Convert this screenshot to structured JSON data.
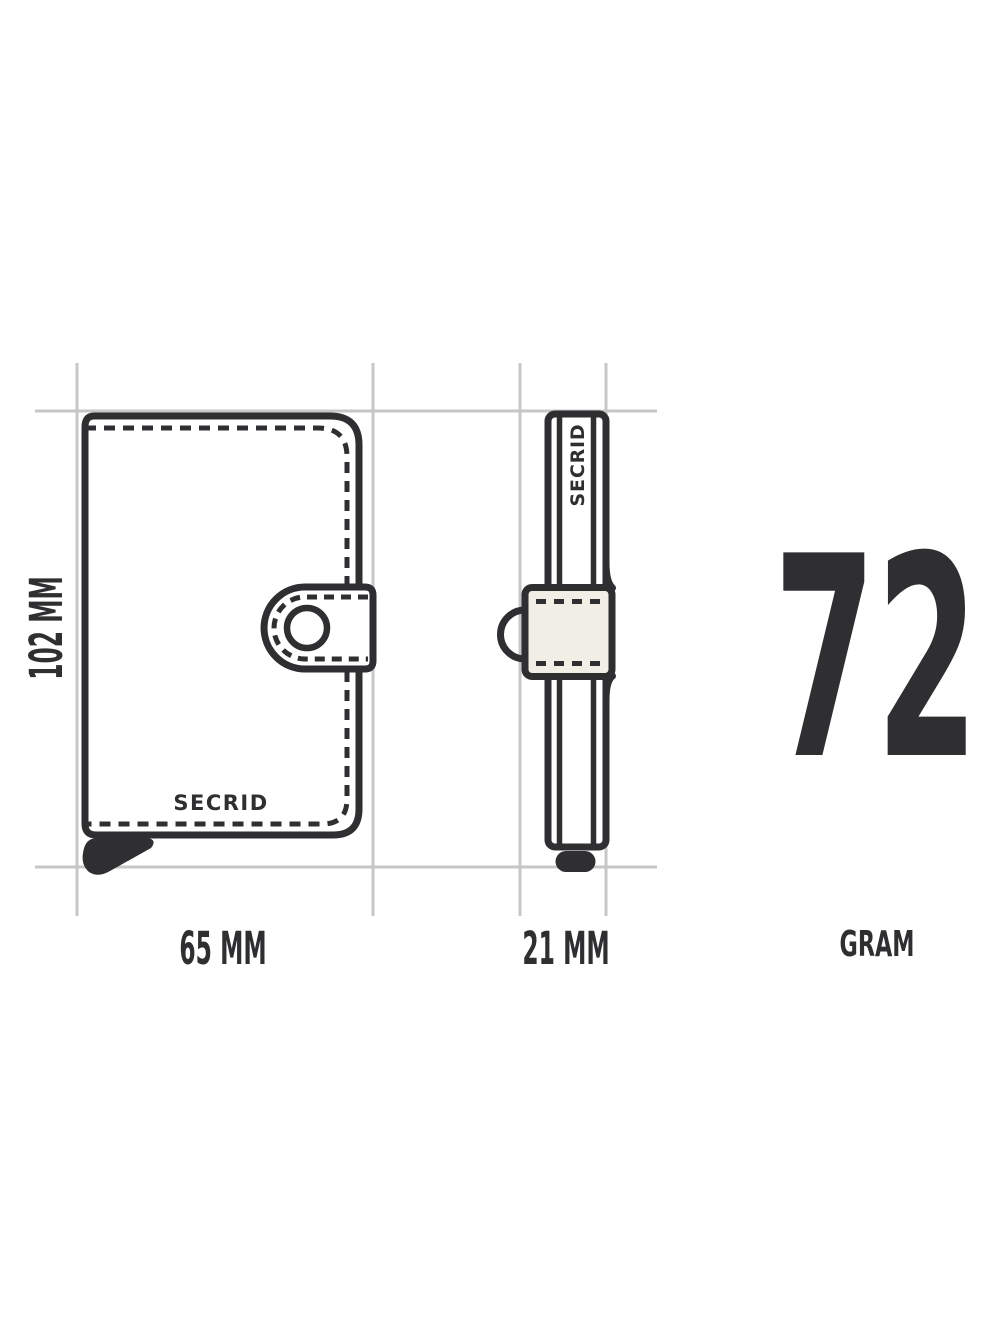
{
  "diagram": {
    "front_view": {
      "brand_label": "SECRID",
      "height_label": "102 MM",
      "width_label": "65 MM"
    },
    "side_view": {
      "brand_label": "SECRID",
      "depth_label": "21 MM"
    },
    "weight": {
      "value": "72",
      "unit_label": "GRAM"
    },
    "measurements": {
      "height_mm": "102",
      "width_mm": "65",
      "depth_mm": "21",
      "weight_gram": "72"
    },
    "colors": {
      "ink": "#2f2e31",
      "grid_line": "#c7c7c7",
      "strap_fill": "#f1efe5",
      "background": "#ffffff"
    }
  }
}
